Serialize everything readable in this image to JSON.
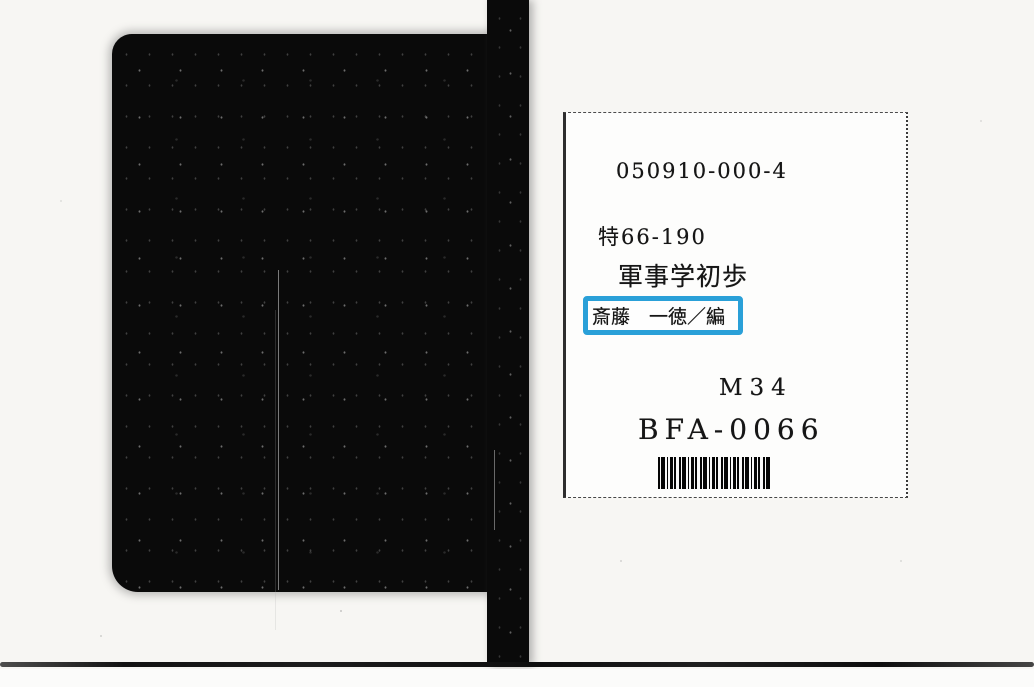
{
  "page": {
    "background_color": "#f7f6f3"
  },
  "scan": {
    "cover_color": "#0a0a0a",
    "rule_color": "#141414"
  },
  "label_card": {
    "call_number": "050910-000-4",
    "classification": "特66-190",
    "title": "軍事学初歩",
    "author": "斎藤　一徳／編",
    "shelf_code": "M34",
    "accession_number": "BFA-0066",
    "highlight_color": "#2aa0d8",
    "barcode_icon": "barcode"
  }
}
